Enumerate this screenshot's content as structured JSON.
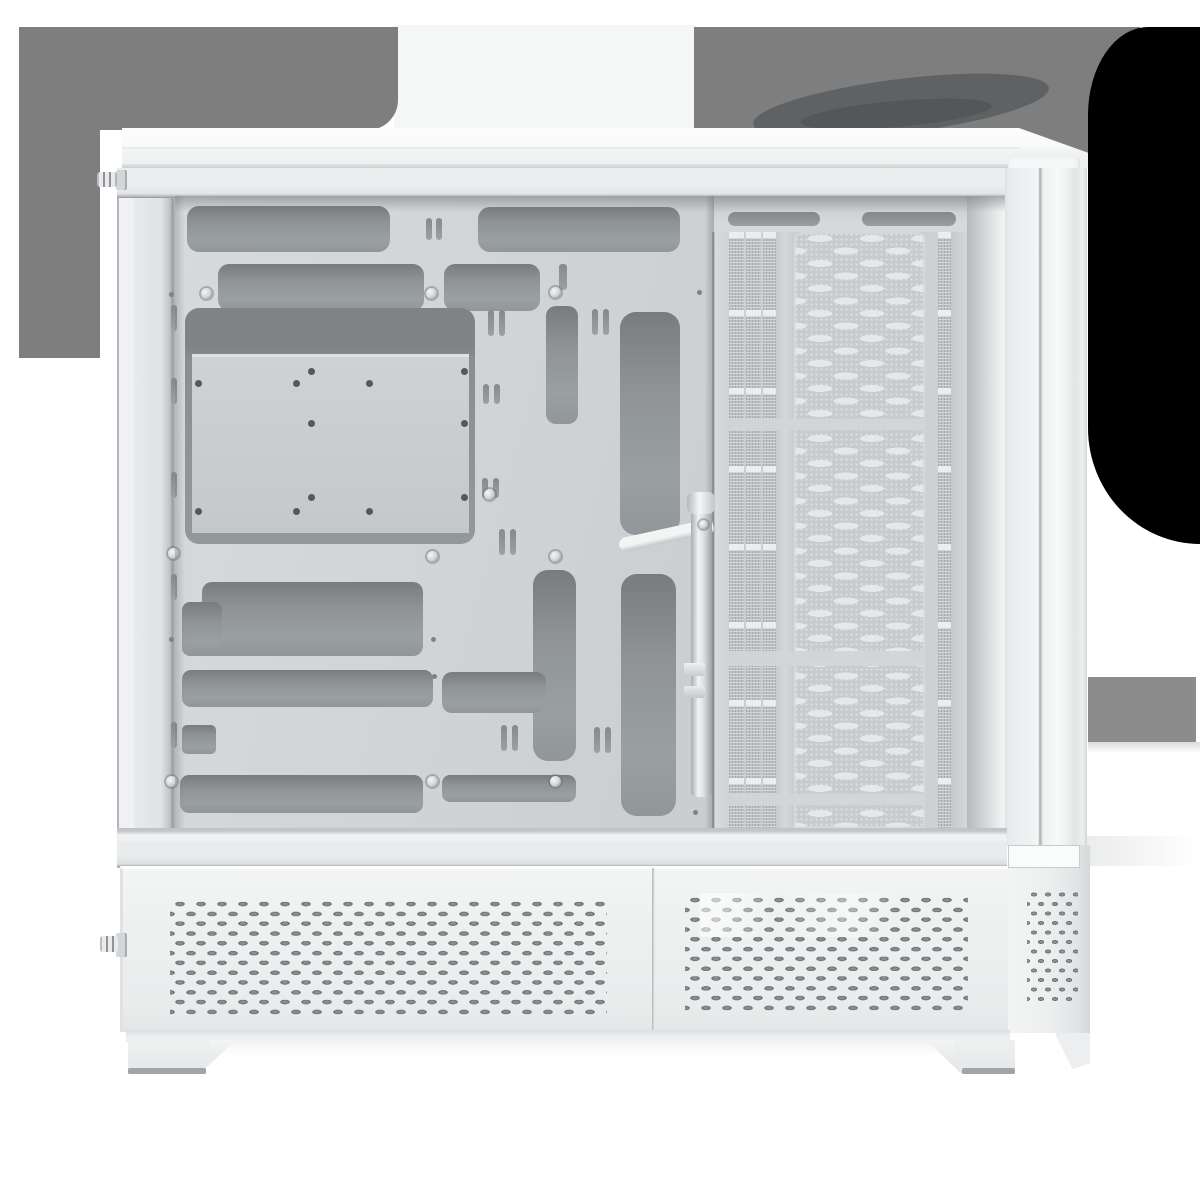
{
  "image": {
    "subject": "White ATX PC case product photo, left side view with side panel removed",
    "background": "white with gray and black studio shadow shapes"
  },
  "colors": {
    "page_bg": "#ffffff",
    "backdrop_gray": "#7e7e7e",
    "swirl": "#5e6265",
    "swirl_core": "#53575a",
    "shadow_black": "#000000",
    "side_card": "#8c8c8c",
    "chimney": "#f5f6f6",
    "case_white": "#f2f4f4",
    "tray_gray": "#d2d5d7",
    "cutout_gray": "#8f9396",
    "vent_dark": "#6e7377",
    "mesh_light": "#e5e7e8"
  },
  "parts": {
    "top_panel": "top cap",
    "motherboard_tray": "cable-routing tray with cutouts",
    "cpu_window": "CPU cooler backplate window",
    "mesh_column": "perforated front mesh column",
    "gpu_bracket": "graphics-card support bracket",
    "psu_shroud": "vented bottom chamber",
    "feet": "case feet",
    "thumbscrews": "side-panel thumbscrews"
  }
}
